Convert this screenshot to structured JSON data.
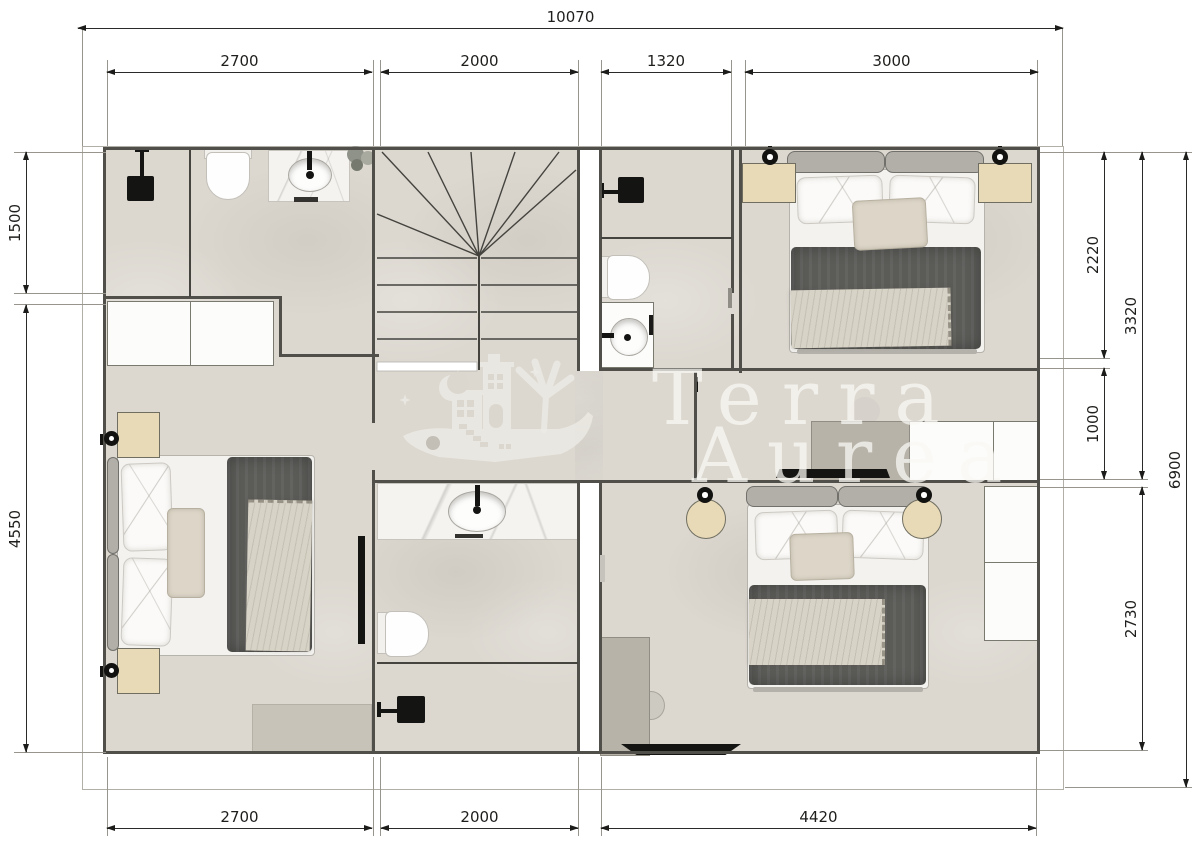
{
  "watermark": {
    "line1": "Terra",
    "line2": "Aurea"
  },
  "dimensions": {
    "top_total": "10070",
    "top": [
      "2700",
      "2000",
      "1320",
      "3000"
    ],
    "left": [
      "1500",
      "4550"
    ],
    "right": [
      "2220",
      "1000",
      "3320",
      "2730",
      "6900"
    ],
    "bottom": [
      "2700",
      "2000",
      "4420"
    ]
  },
  "colors": {
    "floor": "#dcd8d0",
    "wall": "#504f4a",
    "wood": "#e8d9b7",
    "duvet": "#5b5b58",
    "desk": "#b7b3a9",
    "fixture_black": "#141412",
    "watermark": "#edebe5"
  }
}
